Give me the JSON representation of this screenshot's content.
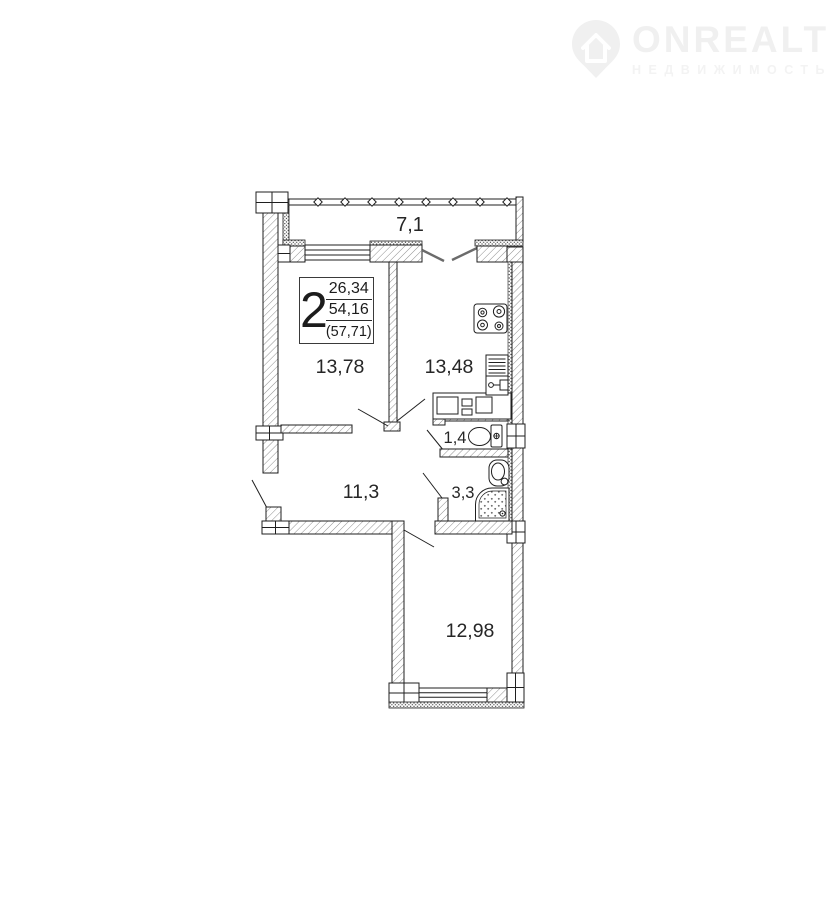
{
  "watermark": {
    "brand": "ONREALT",
    "tagline": "НЕДВИЖИМОСТЬ",
    "color": "#f0f0f0"
  },
  "info_box": {
    "rooms_count": "2",
    "living_area": "26,34",
    "apartment_area": "54,16",
    "total_area": "(57,71)"
  },
  "rooms": {
    "balcony": "7,1",
    "bedroom": "13,78",
    "kitchen": "13,48",
    "wc": "1,4",
    "bathroom": "3,3",
    "hallway": "11,3",
    "bedroom2": "12,98"
  },
  "plan_colors": {
    "wall_outline": "#1f1f1f",
    "hatch": "#8f8f8f",
    "label_text": "#262626"
  }
}
